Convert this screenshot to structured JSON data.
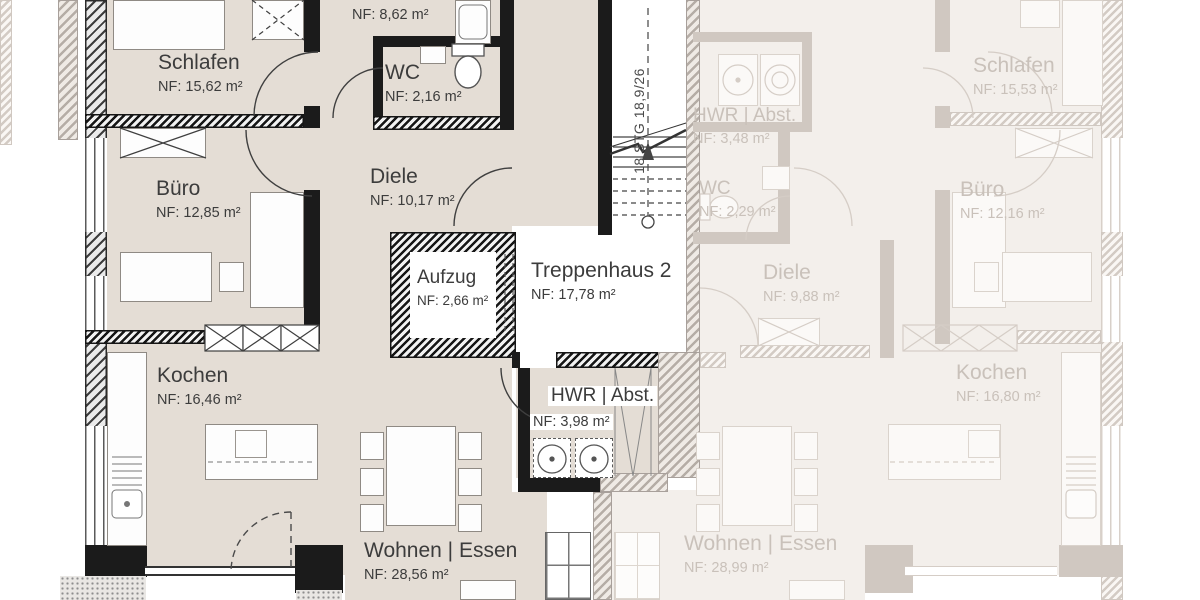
{
  "plan": {
    "stairs": {
      "note": "18 STG 18,9/26"
    },
    "left_unit": {
      "rooms": [
        {
          "id": "schlafen",
          "name": "Schlafen",
          "area": "NF: 15,62 m²"
        },
        {
          "id": "bad",
          "name": "Bad",
          "area": "NF: 8,62 m²"
        },
        {
          "id": "wc",
          "name": "WC",
          "area": "NF: 2,16 m²"
        },
        {
          "id": "buero",
          "name": "Büro",
          "area": "NF: 12,85 m²"
        },
        {
          "id": "diele",
          "name": "Diele",
          "area": "NF: 10,17 m²"
        },
        {
          "id": "aufzug",
          "name": "Aufzug",
          "area": "NF: 2,66 m²"
        },
        {
          "id": "treppenhaus",
          "name": "Treppenhaus 2",
          "area": "NF: 17,78 m²"
        },
        {
          "id": "kochen",
          "name": "Kochen",
          "area": "NF: 16,46 m²"
        },
        {
          "id": "hwr",
          "name": "HWR | Abst.",
          "area": "NF: 3,98 m²"
        },
        {
          "id": "wohnen",
          "name": "Wohnen | Essen",
          "area": "NF: 28,56 m²"
        }
      ]
    },
    "right_unit": {
      "rooms": [
        {
          "id": "hwr",
          "name": "HWR | Abst.",
          "area": "NF: 3,48 m²"
        },
        {
          "id": "wc",
          "name": "WC",
          "area": "NF: 2,29 m²"
        },
        {
          "id": "diele",
          "name": "Diele",
          "area": "NF: 9,88 m²"
        },
        {
          "id": "schlafen",
          "name": "Schlafen",
          "area": "NF: 15,53 m²"
        },
        {
          "id": "buero",
          "name": "Büro",
          "area": "NF: 12,16 m²"
        },
        {
          "id": "kochen",
          "name": "Kochen",
          "area": "NF: 16,80 m²"
        },
        {
          "id": "wohnen",
          "name": "Wohnen | Essen",
          "area": "NF: 28,99 m²"
        }
      ]
    },
    "colors": {
      "active_floor": "#e4ddd5",
      "faded_floor": "#f3efeb",
      "wall": "#1b1b1b",
      "faded_line": "#d3cbc4",
      "active_text": "#3c3c3c",
      "faded_text": "#c9c1ba"
    }
  }
}
